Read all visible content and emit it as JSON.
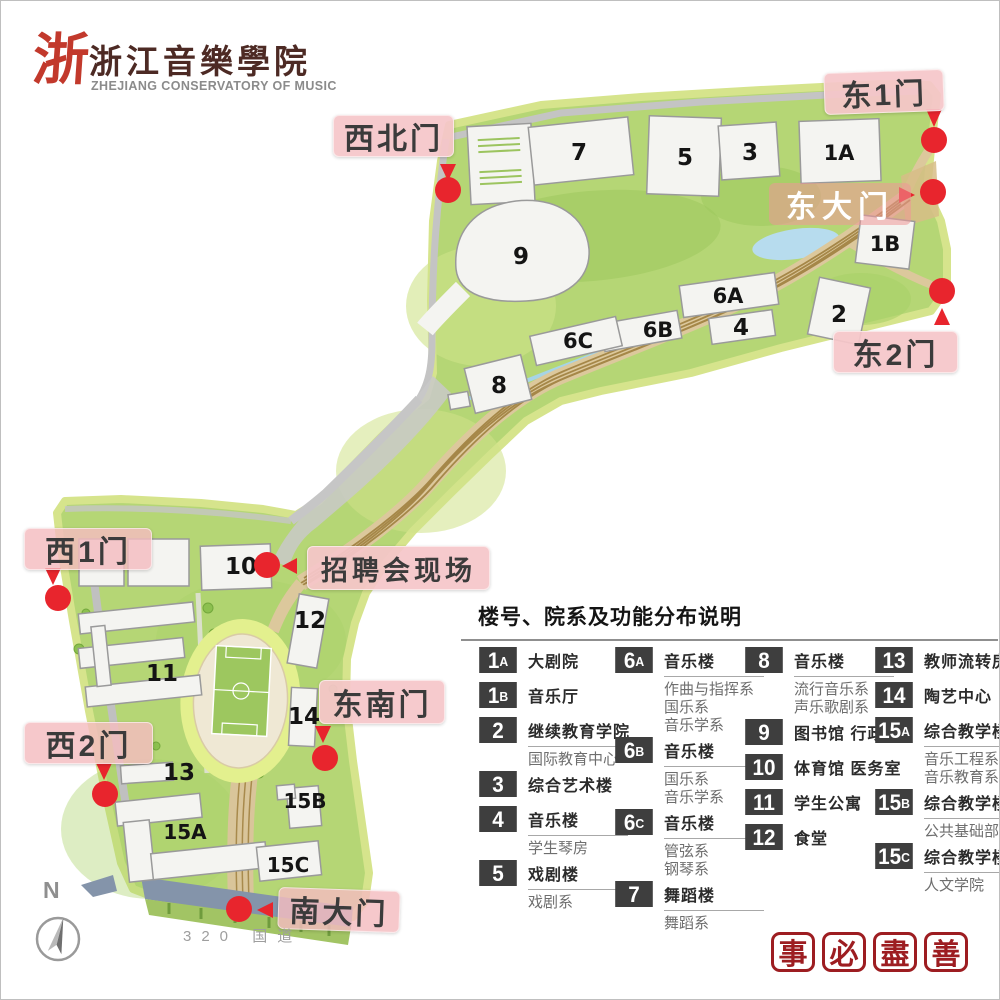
{
  "logo": {
    "mark": "浙",
    "title_cn": "浙江音樂學院",
    "title_en": "ZHEJIANG CONSERVATORY OF MUSIC"
  },
  "gate_labels": {
    "northwest": "西北门",
    "east1": "东1门",
    "east_main": "东大门",
    "east2": "东2门",
    "west1": "西1门",
    "job_fair": "招聘会现场",
    "southeast": "东南门",
    "west2": "西2门",
    "south_main": "南大门"
  },
  "map": {
    "compass": "N",
    "road_label": "320 国道",
    "buildings": [
      {
        "id": "7"
      },
      {
        "id": "5"
      },
      {
        "id": "3"
      },
      {
        "id": "1A"
      },
      {
        "id": "1B"
      },
      {
        "id": "2"
      },
      {
        "id": "9"
      },
      {
        "id": "6A"
      },
      {
        "id": "6B"
      },
      {
        "id": "6C"
      },
      {
        "id": "4"
      },
      {
        "id": "8"
      },
      {
        "id": "10"
      },
      {
        "id": "12"
      },
      {
        "id": "11"
      },
      {
        "id": "14"
      },
      {
        "id": "13"
      },
      {
        "id": "15A"
      },
      {
        "id": "15B"
      },
      {
        "id": "15C"
      }
    ]
  },
  "legend": {
    "title": "楼号、院系及功能分布说明",
    "columns": [
      [
        {
          "id": "1A",
          "title": "大剧院",
          "subs": []
        },
        {
          "id": "1B",
          "title": "音乐厅",
          "subs": []
        },
        {
          "id": "2",
          "title": "继续教育学院",
          "subs": [
            "国际教育中心"
          ]
        },
        {
          "id": "3",
          "title": "综合艺术楼",
          "subs": []
        },
        {
          "id": "4",
          "title": "音乐楼",
          "subs": [
            "学生琴房"
          ]
        },
        {
          "id": "5",
          "title": "戏剧楼",
          "subs": [
            "戏剧系"
          ]
        }
      ],
      [
        {
          "id": "6A",
          "title": "音乐楼",
          "subs": [
            "作曲与指挥系",
            "国乐系",
            "音乐学系"
          ]
        },
        {
          "id": "6B",
          "title": "音乐楼",
          "subs": [
            "国乐系",
            "音乐学系"
          ]
        },
        {
          "id": "6C",
          "title": "音乐楼",
          "subs": [
            "管弦系",
            "钢琴系"
          ]
        },
        {
          "id": "7",
          "title": "舞蹈楼",
          "subs": [
            "舞蹈系"
          ]
        }
      ],
      [
        {
          "id": "8",
          "title": "音乐楼",
          "subs": [
            "流行音乐系",
            "声乐歌剧系"
          ]
        },
        {
          "id": "9",
          "title": "图书馆 行政楼",
          "subs": []
        },
        {
          "id": "10",
          "title": "体育馆 医务室",
          "subs": []
        },
        {
          "id": "11",
          "title": "学生公寓",
          "subs": []
        },
        {
          "id": "12",
          "title": "食堂",
          "subs": []
        }
      ],
      [
        {
          "id": "13",
          "title": "教师流转房",
          "subs": []
        },
        {
          "id": "14",
          "title": "陶艺中心",
          "subs": []
        },
        {
          "id": "15A",
          "title": "综合教学楼",
          "subs": [
            "音乐工程系",
            "音乐教育系"
          ]
        },
        {
          "id": "15B",
          "title": "综合教学楼",
          "subs": [
            "公共基础部"
          ]
        },
        {
          "id": "15C",
          "title": "综合教学楼",
          "subs": [
            "人文学院"
          ]
        }
      ]
    ]
  },
  "seal_motto": {
    "chars": [
      "事",
      "必",
      "盡",
      "善"
    ]
  },
  "colors": {
    "campus_green": "#b5d675",
    "edge_green": "#d6e48c",
    "lawn_green": "#9cc85c",
    "road_gray": "#c4c4c4",
    "path_tan": "#dcc89c",
    "path_brown": "#a0803f",
    "building_fill": "#f4f4f1",
    "water_blue": "#b7dcee",
    "accent_red": "#e8252d",
    "label_pink": "#f5c6c9",
    "badge_dark": "#3e3e3e",
    "seal_red": "#9d1d21",
    "south_road_blue": "#8494aa"
  }
}
